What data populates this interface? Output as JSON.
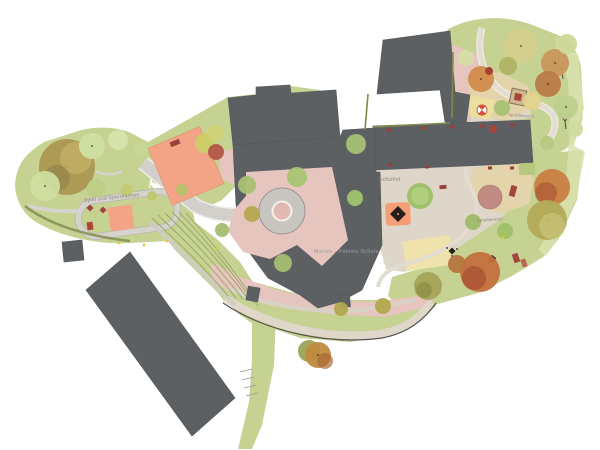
{
  "plan": {
    "type": "architectural-site-plan"
  },
  "labels": {
    "spiel_und_sport": "Spiel und Sportflächen",
    "schulhof": "Schulhof",
    "spielbereich_nord": "Spielbereich",
    "spielbereich_sued": "Spielbereich",
    "gebaeude": "Marien - Palmes Schule"
  },
  "palette": {
    "background": "#ffffff",
    "building": "#5d6063",
    "building_edge": "#53565a",
    "grass": "#c5d292",
    "grass_light": "#d9e2ae",
    "grass_dark": "#9aa862",
    "hedge": "#7d8a4a",
    "paving_pink": "#e7c5bf",
    "paving_beige": "#ddd6c9",
    "sand": "#e3d4ab",
    "sand_yellow": "#ece09e",
    "path": "#d3d0cb",
    "path_light": "#e4ded3",
    "field_orange": "#f3a486",
    "play_orange": "#f59d74",
    "accent_red": "#a3453c",
    "dusty_pink": "#c08b83",
    "plaza_ring": "#c8c5c1",
    "plaza_center": "#e2b9b2",
    "label": "#8a8578",
    "label_building": "#9b9ca0",
    "dot_yellow": "#e6c832",
    "glyph_dark": "#241f1d"
  },
  "trees": [
    {
      "x": 67,
      "y": 167,
      "r": 28,
      "c": "#ab9752"
    },
    {
      "x": 76,
      "y": 158,
      "r": 16,
      "c": "#c3b065",
      "o": 0.8
    },
    {
      "x": 57,
      "y": 178,
      "r": 13,
      "c": "#8d7d45",
      "o": 0.55
    },
    {
      "x": 45,
      "y": 186,
      "r": 15,
      "c": "#cdde9f"
    },
    {
      "x": 92,
      "y": 146,
      "r": 13,
      "c": "#cfe0a2"
    },
    {
      "x": 118,
      "y": 140,
      "r": 10,
      "c": "#d7e4ac"
    },
    {
      "x": 140,
      "y": 150,
      "r": 7,
      "c": "#c8d793"
    },
    {
      "x": 96,
      "y": 188,
      "r": 9,
      "c": "#bccf85"
    },
    {
      "x": 127,
      "y": 190,
      "r": 6,
      "c": "#c2ca71"
    },
    {
      "x": 152,
      "y": 196,
      "r": 5,
      "c": "#bfc76e"
    },
    {
      "x": 182,
      "y": 190,
      "r": 6,
      "c": "#b7c068"
    },
    {
      "x": 205,
      "y": 143,
      "r": 10,
      "c": "#ccce67"
    },
    {
      "x": 216,
      "y": 152,
      "r": 8,
      "c": "#b45648"
    },
    {
      "x": 215,
      "y": 133,
      "r": 8,
      "c": "#d0d276"
    },
    {
      "x": 252,
      "y": 214,
      "r": 8,
      "c": "#b5a84e"
    },
    {
      "x": 222,
      "y": 230,
      "r": 7,
      "c": "#a3bd71"
    },
    {
      "x": 247,
      "y": 185,
      "r": 9,
      "c": "#a6c173"
    },
    {
      "x": 297,
      "y": 177,
      "r": 10,
      "c": "#a9c472"
    },
    {
      "x": 356,
      "y": 144,
      "r": 10,
      "c": "#a4c174"
    },
    {
      "x": 283,
      "y": 263,
      "r": 9,
      "c": "#a3bd71"
    },
    {
      "x": 355,
      "y": 198,
      "r": 8,
      "c": "#9fc46e"
    },
    {
      "x": 420,
      "y": 196,
      "r": 13,
      "c": "#9cc068"
    },
    {
      "x": 420,
      "y": 196,
      "r": 9,
      "c": "#b2d07e",
      "o": 0.9
    },
    {
      "x": 521,
      "y": 46,
      "r": 17,
      "c": "#d5cf8c"
    },
    {
      "x": 555,
      "y": 63,
      "r": 14,
      "c": "#c9975c"
    },
    {
      "x": 567,
      "y": 44,
      "r": 10,
      "c": "#ccd898"
    },
    {
      "x": 548,
      "y": 84,
      "r": 13,
      "c": "#bb7a48"
    },
    {
      "x": 508,
      "y": 66,
      "r": 9,
      "c": "#b0b363"
    },
    {
      "x": 481,
      "y": 79,
      "r": 13,
      "c": "#d08c4a"
    },
    {
      "x": 489,
      "y": 71,
      "r": 4,
      "c": "#a33d33"
    },
    {
      "x": 466,
      "y": 58,
      "r": 8,
      "c": "#d4dfa8"
    },
    {
      "x": 502,
      "y": 108,
      "r": 8,
      "c": "#a9c173"
    },
    {
      "x": 532,
      "y": 101,
      "r": 9,
      "c": "#e3d28d"
    },
    {
      "x": 566,
      "y": 107,
      "r": 12,
      "c": "#bed08d"
    },
    {
      "x": 575,
      "y": 129,
      "r": 8,
      "c": "#cddc9f"
    },
    {
      "x": 493,
      "y": 129,
      "r": 4,
      "c": "#a8463c"
    },
    {
      "x": 547,
      "y": 143,
      "r": 7,
      "c": "#b5c87e"
    },
    {
      "x": 552,
      "y": 187,
      "r": 18,
      "c": "#c97e42"
    },
    {
      "x": 546,
      "y": 193,
      "r": 11,
      "c": "#b25c38",
      "o": 0.8
    },
    {
      "x": 547,
      "y": 220,
      "r": 20,
      "c": "#b3aa58"
    },
    {
      "x": 552,
      "y": 226,
      "r": 13,
      "c": "#c6bf74",
      "o": 0.85
    },
    {
      "x": 473,
      "y": 222,
      "r": 8,
      "c": "#9fba6a"
    },
    {
      "x": 505,
      "y": 231,
      "r": 8,
      "c": "#9fc068"
    },
    {
      "x": 480,
      "y": 272,
      "r": 20,
      "c": "#c4703d"
    },
    {
      "x": 474,
      "y": 278,
      "r": 12,
      "c": "#ad5535",
      "o": 0.85
    },
    {
      "x": 457,
      "y": 264,
      "r": 9,
      "c": "#b8743f"
    },
    {
      "x": 428,
      "y": 286,
      "r": 14,
      "c": "#a5a458"
    },
    {
      "x": 424,
      "y": 290,
      "r": 8,
      "c": "#8f9148",
      "o": 0.85
    },
    {
      "x": 383,
      "y": 306,
      "r": 8,
      "c": "#b3a84e"
    },
    {
      "x": 341,
      "y": 309,
      "r": 7,
      "c": "#b3a84e"
    },
    {
      "x": 309,
      "y": 351,
      "r": 11,
      "c": "#9aa355"
    },
    {
      "x": 318,
      "y": 355,
      "r": 13,
      "c": "#bf8a3f"
    },
    {
      "x": 325,
      "y": 361,
      "r": 8,
      "c": "#a86a38",
      "o": 0.7
    }
  ],
  "equipment": [
    {
      "n": "field-bench",
      "x": 175,
      "y": 143,
      "w": 10,
      "h": 5,
      "rot": -23,
      "c": "#9c423a"
    },
    {
      "n": "play-diamond",
      "x": 90,
      "y": 208,
      "w": 5,
      "h": 5,
      "rot": 45,
      "c": "#a3453c"
    },
    {
      "n": "play-diamond",
      "x": 103,
      "y": 210,
      "w": 5,
      "h": 5,
      "rot": 45,
      "c": "#a3453c"
    },
    {
      "n": "play-box",
      "x": 90,
      "y": 226,
      "w": 6,
      "h": 8,
      "rot": -8,
      "c": "#b0453c"
    },
    {
      "n": "bench",
      "x": 389,
      "y": 130,
      "w": 5,
      "h": 3,
      "rot": -2,
      "c": "#993f38"
    },
    {
      "n": "bench",
      "x": 424,
      "y": 128,
      "w": 5,
      "h": 3,
      "rot": -2,
      "c": "#993f38"
    },
    {
      "n": "bench",
      "x": 452,
      "y": 127,
      "w": 5,
      "h": 3,
      "rot": -2,
      "c": "#993f38"
    },
    {
      "n": "bench",
      "x": 483,
      "y": 126,
      "w": 5,
      "h": 3,
      "rot": -2,
      "c": "#993f38"
    },
    {
      "n": "bench",
      "x": 512,
      "y": 125,
      "w": 5,
      "h": 3,
      "rot": -2,
      "c": "#993f38"
    },
    {
      "n": "bench",
      "x": 390,
      "y": 165,
      "w": 4,
      "h": 3,
      "rot": -2,
      "c": "#993f38"
    },
    {
      "n": "bench",
      "x": 427,
      "y": 167,
      "w": 4,
      "h": 3,
      "rot": -2,
      "c": "#993f38"
    },
    {
      "n": "bench",
      "x": 490,
      "y": 168,
      "w": 4,
      "h": 3,
      "rot": -2,
      "c": "#993f38"
    },
    {
      "n": "bench",
      "x": 512,
      "y": 168,
      "w": 4,
      "h": 3,
      "rot": -2,
      "c": "#993f38"
    },
    {
      "n": "bench",
      "x": 443,
      "y": 187,
      "w": 7,
      "h": 4,
      "rot": -5,
      "c": "#993f38"
    },
    {
      "n": "bench",
      "x": 513,
      "y": 191,
      "w": 6,
      "h": 11,
      "rot": 15,
      "c": "#a3453c"
    },
    {
      "n": "bench",
      "x": 516,
      "y": 258,
      "w": 6,
      "h": 9,
      "rot": -20,
      "c": "#a3453c"
    },
    {
      "n": "bench",
      "x": 524,
      "y": 263,
      "w": 5,
      "h": 8,
      "rot": -20,
      "c": "#b86a50"
    }
  ],
  "lamps": [
    [
      119,
      243
    ],
    [
      144,
      245
    ],
    [
      167,
      241
    ],
    [
      217,
      248
    ],
    [
      503,
      237
    ]
  ]
}
